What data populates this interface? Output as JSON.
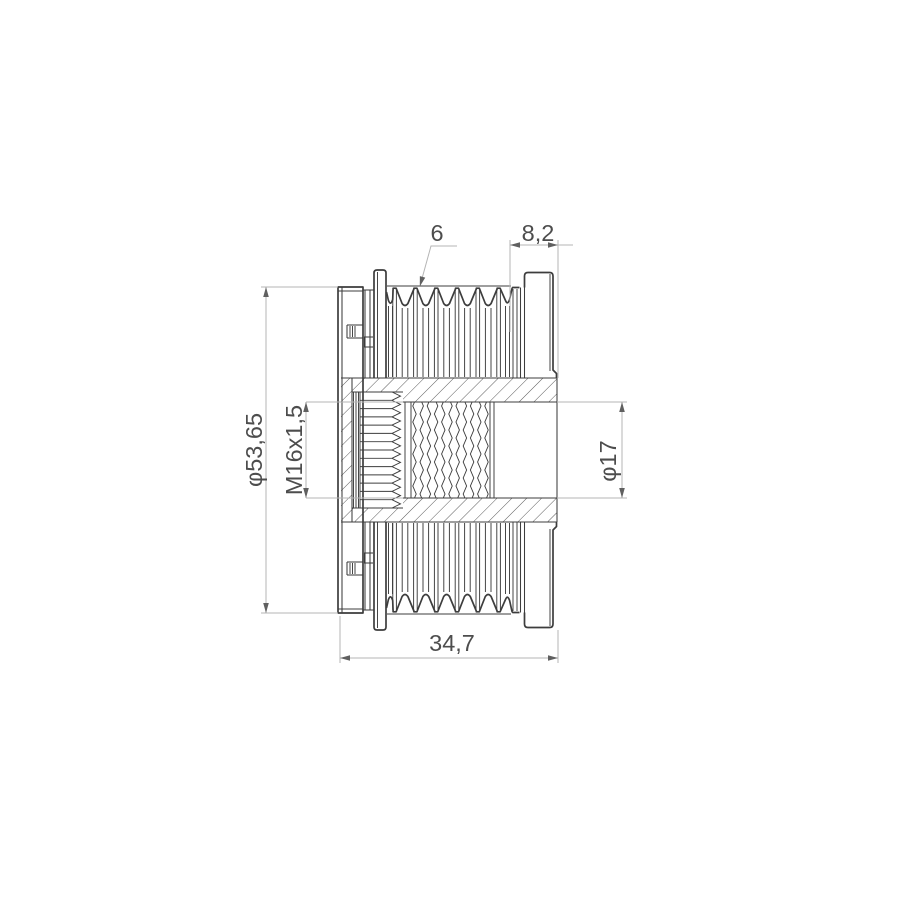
{
  "labels": {
    "rib_count": "6",
    "end_section_width": "8,2",
    "outer_diameter": "φ53,65",
    "thread_spec": "M16x1,5",
    "bore_diameter": "φ17",
    "overall_width": "34,7"
  },
  "colors": {
    "background": "#ffffff",
    "outline": "#3d3d3d",
    "dimension_line": "#b5b5b5",
    "arrow": "#606060",
    "text": "#4d4d4d"
  }
}
